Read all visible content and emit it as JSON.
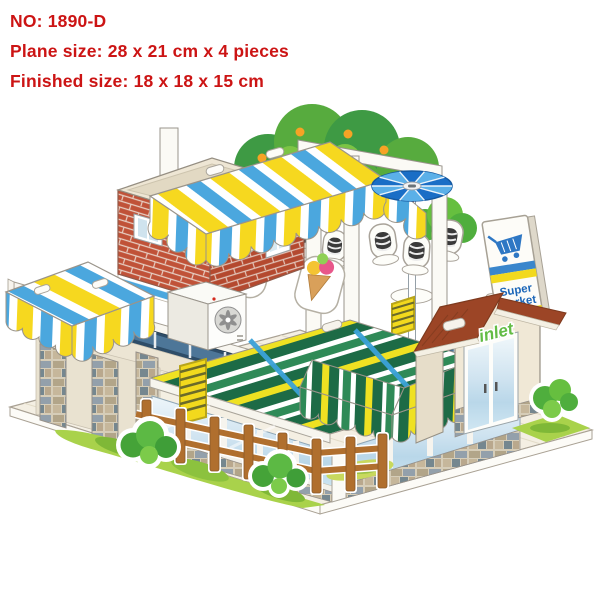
{
  "header": {
    "line1": "NO: 1890-D",
    "line2": "Plane size: 28 x 21 cm x 4 pieces",
    "line3": "Finished size: 18 x 18 x 15 cm"
  },
  "model": {
    "signs": {
      "bar": "BAR",
      "supermarket_line1": "Super",
      "supermarket_line2": "Market",
      "supermarket_sale": "SALE",
      "entrance": "inlet"
    },
    "colors": {
      "spec_text_red": "#cc1414",
      "awning_yellow": "#f6d81f",
      "awning_blue": "#4ba7de",
      "awning_green_dark": "#1d6b46",
      "awning_green_mid": "#2f8a57",
      "brick_red": "#c05238",
      "roof_brown": "#9c4526",
      "parasol_blue": "#1a6ec6",
      "grass_green": "#a9d24b",
      "bush_green": "#4fae3d",
      "wood_fence": "#b06f2e",
      "market_blue": "#1c66b8",
      "sale_red": "#d4281c",
      "inlet_green": "#63bc45",
      "wall_cream": "#ece5d4",
      "window_navy": "#2e4d68",
      "glass_blue": "#c2dcec",
      "stone_gray": "#93a0ab",
      "deck_cream": "#f4efe3"
    }
  }
}
